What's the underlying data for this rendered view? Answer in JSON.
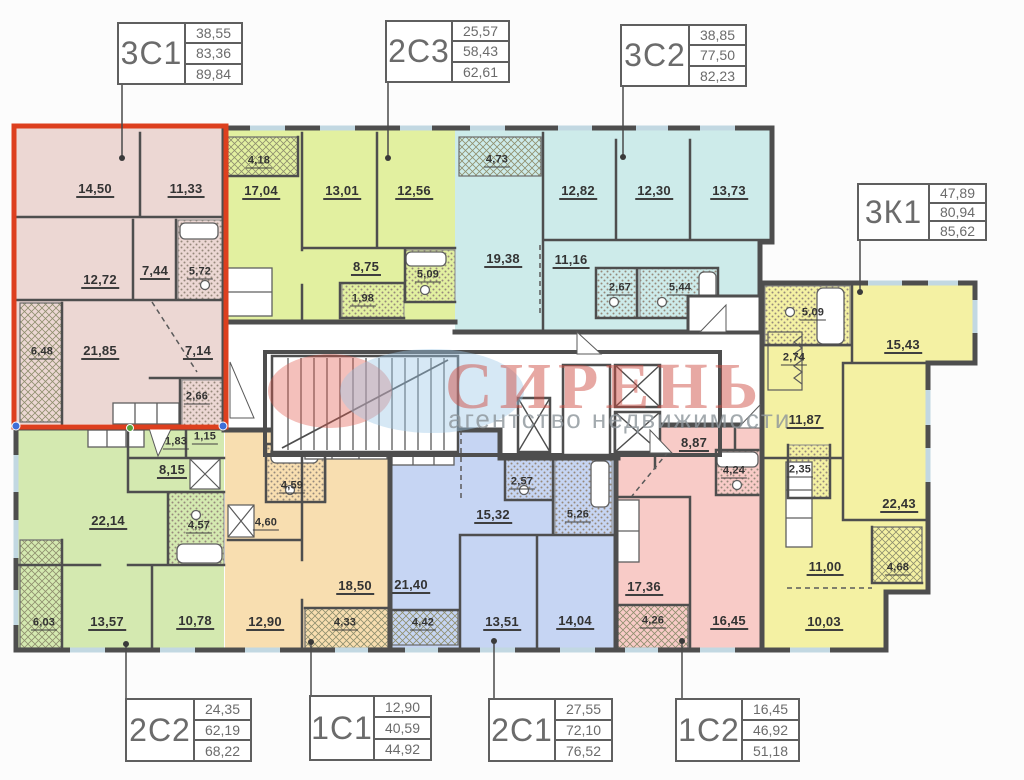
{
  "watermark": {
    "brand": "СИРЕНЬ",
    "subtitle": "агентство недвижимости",
    "logo_red": "#e2594c",
    "logo_blue": "#9ec7e8"
  },
  "highlight": {
    "unit": "3С1",
    "color": "#dd3f1e"
  },
  "callouts": [
    {
      "unit": "3С1",
      "values": [
        "38,55",
        "83,36",
        "89,84"
      ]
    },
    {
      "unit": "2С3",
      "values": [
        "25,57",
        "58,43",
        "62,61"
      ]
    },
    {
      "unit": "3С2",
      "values": [
        "38,85",
        "77,50",
        "82,23"
      ]
    },
    {
      "unit": "3К1",
      "values": [
        "47,89",
        "80,94",
        "85,62"
      ]
    },
    {
      "unit": "2С2",
      "values": [
        "24,35",
        "62,19",
        "68,22"
      ]
    },
    {
      "unit": "1С1",
      "values": [
        "12,90",
        "40,59",
        "44,92"
      ]
    },
    {
      "unit": "2С1",
      "values": [
        "27,55",
        "72,10",
        "76,52"
      ]
    },
    {
      "unit": "1С2",
      "values": [
        "16,45",
        "46,92",
        "51,18"
      ]
    }
  ],
  "apartments": [
    {
      "unit": "3С1",
      "fill": "#ecd7d3",
      "rooms": [
        "14,50",
        "11,33",
        "12,72",
        "7,44",
        "5,72",
        "6,48",
        "21,85",
        "7,14",
        "2,66"
      ]
    },
    {
      "unit": "2С3",
      "fill": "#e2f0a0",
      "rooms": [
        "4,18",
        "17,04",
        "13,01",
        "12,56",
        "8,75",
        "5,09",
        "1,98"
      ]
    },
    {
      "unit": "3С2",
      "fill": "#cdebea",
      "rooms": [
        "4,73",
        "12,82",
        "12,30",
        "13,73",
        "19,38",
        "11,16",
        "2,67",
        "5,44"
      ]
    },
    {
      "unit": "3К1",
      "fill": "#f4f1a3",
      "rooms": [
        "5,09",
        "2,74",
        "15,43",
        "11,87",
        "2,35",
        "22,43",
        "11,00",
        "4,68",
        "10,03"
      ]
    },
    {
      "unit": "2С2",
      "fill": "#d4e9b0",
      "rooms": [
        "1,83",
        "1,15",
        "8,15",
        "22,14",
        "4,57",
        "6,03",
        "13,57",
        "10,78"
      ]
    },
    {
      "unit": "1С1",
      "fill": "#f8deb0",
      "rooms": [
        "4,59",
        "4,60",
        "12,90",
        "18,50",
        "4,33"
      ]
    },
    {
      "unit": "2С1",
      "fill": "#c6d5f3",
      "rooms": [
        "2,57",
        "15,32",
        "5,26",
        "21,40",
        "4,42",
        "13,51",
        "14,04"
      ]
    },
    {
      "unit": "1С2",
      "fill": "#f8cbc7",
      "rooms": [
        "8,87",
        "4,24",
        "17,36",
        "4,26",
        "16,45"
      ]
    }
  ]
}
